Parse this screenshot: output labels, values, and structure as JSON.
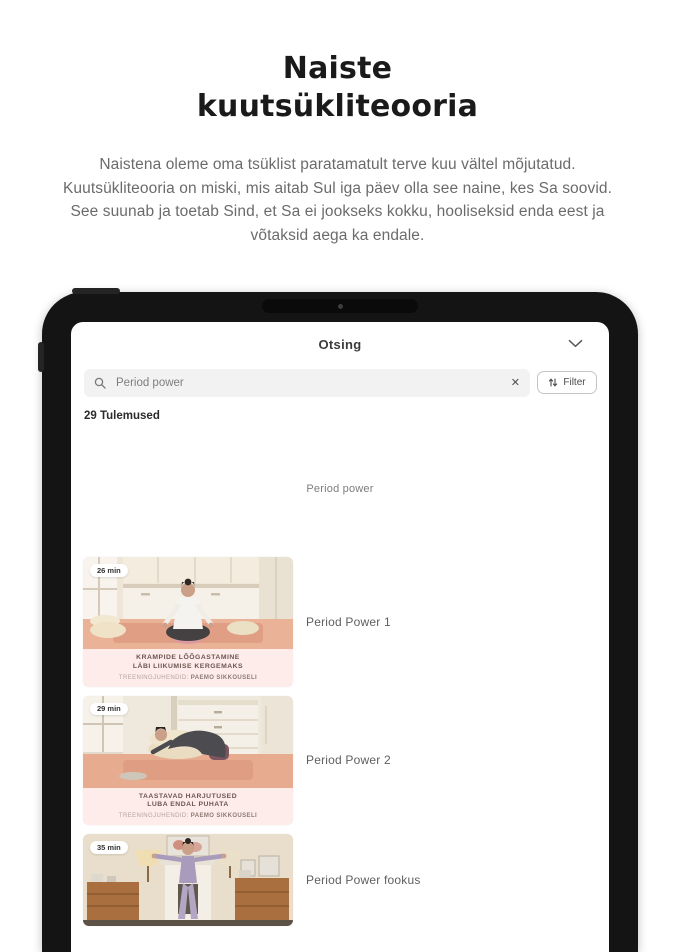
{
  "hero": {
    "title_line1": "Naiste",
    "title_line2": "kuutsükliteooria",
    "paragraph": "Naistena oleme oma tsüklist paratamatult terve kuu vältel mõjutatud. Kuutsükliteooria on miski, mis aitab Sul iga päev olla see naine, kes Sa soovid. See suunab ja toetab Sind, et Sa ei jookseks kokku, hooliseksid enda eest ja võtaksid aega ka endale."
  },
  "tablet": {
    "header": {
      "title": "Otsing",
      "collapse_icon": "chevron-down"
    },
    "search": {
      "icon": "magnifier",
      "value": "Period power",
      "clear_icon": "close-x",
      "filter": {
        "label": "Filter",
        "icon": "sort-arrows"
      }
    },
    "results_count": "29 Tulemused",
    "section_label": "Period power",
    "items": [
      {
        "duration_badge": "26 min",
        "overlay_title_line1": "KRAMPIDE LÕÕGASTAMINE",
        "overlay_title_line2": "LÄBI LIIKUMISE KERGEMAKS",
        "trainer_prefix": "TREENINGJUHENDID:",
        "trainer_name": "PAEMO SIKKOUSELI",
        "title": "Period Power 1"
      },
      {
        "duration_badge": "29 min",
        "overlay_title_line1": "TAASTAVAD HARJUTUSED",
        "overlay_title_line2": "LUBA ENDAL PUHATA",
        "trainer_prefix": "TREENINGJUHENDID:",
        "trainer_name": "PAEMO SIKKOUSELI",
        "title": "Period Power 2"
      },
      {
        "duration_badge": "35 min",
        "title": "Period Power fookus"
      }
    ],
    "colors": {
      "band_pink": "#fdecea",
      "floor_salmon": "#e8ab8f",
      "badge_bg": "#ffffff",
      "frame_black": "#141414"
    }
  }
}
